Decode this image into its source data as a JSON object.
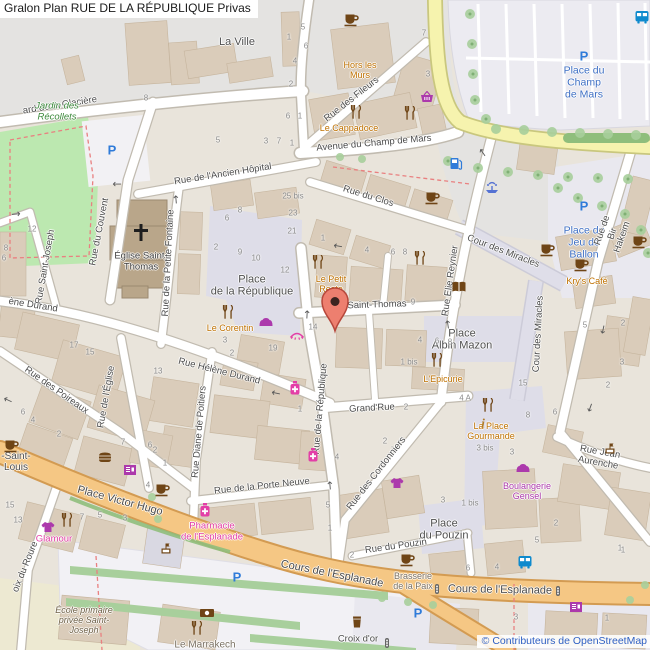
{
  "title": {
    "text": "Gralon Plan RUE DE LA RÉPUBLIQUE Privas"
  },
  "attribution": {
    "text": "© Contributeurs de OpenStreetMap"
  },
  "marker": {
    "color": "#ED7F6F"
  },
  "palette": {
    "road_primary": "#F5C784",
    "road_tertiary": "#F6F3AE",
    "road_minor": "#FFFFFF",
    "pedestrian": "#DEDDE8",
    "park": "#BCE8B0",
    "building": "#DACCBA",
    "poi_food": "#BF7100",
    "poi_shop": "#AC39AC",
    "poi_pink": "#E33FA7",
    "poi_transport_blue": "#2F7BD9",
    "place_blue": "#3E6FC4",
    "attribution_blue": "#2E5FC3"
  },
  "map": {
    "labels": [
      {
        "t": "ard de la Glacière",
        "x": 60,
        "y": 106,
        "r": -9,
        "k": "street"
      },
      {
        "t": "La Ville",
        "x": 237,
        "y": 42,
        "r": 0,
        "k": "place"
      },
      {
        "t": "Rue des Fileurs",
        "x": 352,
        "y": 100,
        "r": -38,
        "k": "street"
      },
      {
        "t": "Hors les\nMurs",
        "x": 360,
        "y": 70,
        "r": 0,
        "k": "food"
      },
      {
        "t": "Le Cappadoce",
        "x": 349,
        "y": 128,
        "r": 0,
        "k": "food"
      },
      {
        "t": "Avenue du Champ de Mars",
        "x": 374,
        "y": 144,
        "r": -5,
        "k": "street"
      },
      {
        "t": "Place du\nChamp\nde Mars",
        "x": 584,
        "y": 83,
        "r": 0,
        "k": "pblue"
      },
      {
        "t": "Rue de l'Ancien Hôpital",
        "x": 223,
        "y": 175,
        "r": -9,
        "k": "street"
      },
      {
        "t": "Rue du Clos",
        "x": 368,
        "y": 197,
        "r": 17,
        "k": "street"
      },
      {
        "t": "Rue du Couvent",
        "x": 100,
        "y": 232,
        "r": -79,
        "k": "street"
      },
      {
        "t": "Jardin des\nRécollets",
        "x": 57,
        "y": 112,
        "r": 0,
        "k": "park"
      },
      {
        "t": "Église Saint-\nThomas",
        "x": 141,
        "y": 262,
        "r": 0,
        "k": "church"
      },
      {
        "t": "Rue Saint-Joseph",
        "x": 46,
        "y": 267,
        "r": -80,
        "k": "street"
      },
      {
        "t": "Rue de la Petite Fontaine",
        "x": 169,
        "y": 263,
        "r": -87,
        "k": "street"
      },
      {
        "t": "Place\nde la République",
        "x": 252,
        "y": 286,
        "r": 0,
        "k": "place"
      },
      {
        "t": "Le Petit\nResto",
        "x": 331,
        "y": 284,
        "r": 0,
        "k": "food"
      },
      {
        "t": "Le Corentin",
        "x": 230,
        "y": 328,
        "r": 0,
        "k": "food"
      },
      {
        "t": "Rue Saint-Thomas",
        "x": 367,
        "y": 306,
        "r": -2,
        "k": "street"
      },
      {
        "t": "Rue Elie Reynier",
        "x": 451,
        "y": 281,
        "r": -82,
        "k": "street"
      },
      {
        "t": "Cour des Miracles",
        "x": 503,
        "y": 252,
        "r": 21,
        "k": "street"
      },
      {
        "t": "Cour des Miracles",
        "x": 539,
        "y": 334,
        "r": -87,
        "k": "street"
      },
      {
        "t": "Place du\nJeu de\nBallon",
        "x": 584,
        "y": 243,
        "r": 0,
        "k": "pblue"
      },
      {
        "t": "Kry's Café",
        "x": 587,
        "y": 281,
        "r": 0,
        "k": "food"
      },
      {
        "t": "Rue de Bir Hakeim",
        "x": 613,
        "y": 234,
        "r": -71,
        "k": "street"
      },
      {
        "t": "Place\nAlbin Mazon",
        "x": 462,
        "y": 340,
        "r": 0,
        "k": "place"
      },
      {
        "t": "L'Epicurie",
        "x": 443,
        "y": 379,
        "r": 0,
        "k": "food"
      },
      {
        "t": "ène Durand",
        "x": 33,
        "y": 306,
        "r": 9,
        "k": "street"
      },
      {
        "t": "Rue Hélène Durand",
        "x": 219,
        "y": 372,
        "r": 14,
        "k": "street"
      },
      {
        "t": "Rue des Poireaux",
        "x": 56,
        "y": 391,
        "r": 35,
        "k": "street"
      },
      {
        "t": "Rue de l'Église",
        "x": 107,
        "y": 397,
        "r": -80,
        "k": "street"
      },
      {
        "t": "Rue de la République",
        "x": 321,
        "y": 409,
        "r": -85,
        "k": "street"
      },
      {
        "t": "Grand'Rue",
        "x": 372,
        "y": 409,
        "r": -3,
        "k": "street"
      },
      {
        "t": "Rue Diane de Poitiers",
        "x": 200,
        "y": 432,
        "r": -85,
        "k": "street"
      },
      {
        "t": "La Place\nGourmande",
        "x": 491,
        "y": 431,
        "r": 0,
        "k": "food"
      },
      {
        "t": "Rue de la Porte Neuve",
        "x": 262,
        "y": 487,
        "r": -6,
        "k": "street"
      },
      {
        "t": "Rue des Cordonniers",
        "x": 377,
        "y": 474,
        "r": -52,
        "k": "street"
      },
      {
        "t": "Boulangerie\nGensel",
        "x": 527,
        "y": 491,
        "r": 0,
        "k": "shop"
      },
      {
        "t": "Rue Jean Aurenche",
        "x": 599,
        "y": 458,
        "r": 10,
        "k": "street"
      },
      {
        "t": "Place Victor Hugo",
        "x": 120,
        "y": 501,
        "r": 15,
        "k": "street",
        "fs": 11
      },
      {
        "t": "Pharmacie\nde l'Esplanade",
        "x": 212,
        "y": 532,
        "r": 0,
        "k": "pink"
      },
      {
        "t": "-Saint-\nLouis",
        "x": 16,
        "y": 462,
        "r": 0,
        "k": "place",
        "fs": 10
      },
      {
        "t": "Glamour",
        "x": 54,
        "y": 540,
        "r": 0,
        "k": "pink"
      },
      {
        "t": "Place\ndu Pouzin",
        "x": 444,
        "y": 530,
        "r": 0,
        "k": "place"
      },
      {
        "t": "Rue du Pouzin",
        "x": 396,
        "y": 547,
        "r": -8,
        "k": "street"
      },
      {
        "t": "Cours de l'Esplanade",
        "x": 332,
        "y": 574,
        "r": 11,
        "k": "street",
        "fs": 11
      },
      {
        "t": "Cours de l'Esplanade",
        "x": 500,
        "y": 590,
        "r": 1,
        "k": "street",
        "fs": 11
      },
      {
        "t": "Brasserie\nde la Paix",
        "x": 413,
        "y": 581,
        "r": 0,
        "k": "gpoi"
      },
      {
        "t": "oix du Roure",
        "x": 26,
        "y": 567,
        "r": -68,
        "k": "street"
      },
      {
        "t": "École primaire\nprivée Saint-\nJoseph",
        "x": 84,
        "y": 620,
        "r": 0,
        "k": "school"
      },
      {
        "t": "Le Marrakech",
        "x": 205,
        "y": 645,
        "r": 0,
        "k": "gpoi",
        "fs": 10
      },
      {
        "t": "Croix d'or",
        "x": 358,
        "y": 640,
        "r": 0,
        "k": "street"
      }
    ],
    "house_numbers": [
      [
        146,
        98,
        "8"
      ],
      [
        303,
        27,
        "5"
      ],
      [
        289,
        37,
        "1"
      ],
      [
        306,
        46,
        "6"
      ],
      [
        295,
        61,
        "4"
      ],
      [
        291,
        84,
        "2"
      ],
      [
        288,
        116,
        "6"
      ],
      [
        300,
        116,
        "1"
      ],
      [
        424,
        33,
        "7"
      ],
      [
        428,
        74,
        "3"
      ],
      [
        218,
        140,
        "5"
      ],
      [
        266,
        141,
        "3"
      ],
      [
        279,
        141,
        "7"
      ],
      [
        292,
        143,
        "1"
      ],
      [
        32,
        229,
        "12"
      ],
      [
        6,
        248,
        "8"
      ],
      [
        4,
        258,
        "6"
      ],
      [
        293,
        196,
        "25 bis"
      ],
      [
        293,
        213,
        "23"
      ],
      [
        292,
        231,
        "21"
      ],
      [
        240,
        210,
        "8"
      ],
      [
        227,
        218,
        "6"
      ],
      [
        216,
        247,
        "2"
      ],
      [
        240,
        252,
        "9"
      ],
      [
        256,
        258,
        "10"
      ],
      [
        285,
        270,
        "12"
      ],
      [
        323,
        238,
        "1"
      ],
      [
        367,
        250,
        "4"
      ],
      [
        393,
        252,
        "6"
      ],
      [
        405,
        252,
        "8"
      ],
      [
        74,
        345,
        "17"
      ],
      [
        90,
        352,
        "15"
      ],
      [
        158,
        371,
        "13"
      ],
      [
        225,
        340,
        "3"
      ],
      [
        232,
        353,
        "2"
      ],
      [
        273,
        348,
        "19"
      ],
      [
        346,
        296,
        "1"
      ],
      [
        413,
        302,
        "9"
      ],
      [
        313,
        327,
        "14"
      ],
      [
        300,
        409,
        "1"
      ],
      [
        406,
        407,
        "2"
      ],
      [
        385,
        441,
        "2"
      ],
      [
        337,
        457,
        "4"
      ],
      [
        409,
        362,
        "1 bis"
      ],
      [
        23,
        412,
        "6"
      ],
      [
        33,
        420,
        "4"
      ],
      [
        59,
        434,
        "2"
      ],
      [
        165,
        463,
        "1"
      ],
      [
        123,
        442,
        "7"
      ],
      [
        150,
        445,
        "6"
      ],
      [
        155,
        450,
        "2"
      ],
      [
        148,
        485,
        "4"
      ],
      [
        10,
        505,
        "15"
      ],
      [
        18,
        520,
        "13"
      ],
      [
        82,
        517,
        "7"
      ],
      [
        100,
        515,
        "5"
      ],
      [
        125,
        518,
        "3"
      ],
      [
        328,
        505,
        "5"
      ],
      [
        330,
        528,
        "1"
      ],
      [
        352,
        555,
        "2"
      ],
      [
        443,
        500,
        "3"
      ],
      [
        470,
        503,
        "1 bis"
      ],
      [
        468,
        568,
        "6"
      ],
      [
        497,
        567,
        "4"
      ],
      [
        620,
        548,
        "1"
      ],
      [
        516,
        617,
        "3"
      ],
      [
        607,
        618,
        "1"
      ],
      [
        485,
        448,
        "3 bis"
      ],
      [
        512,
        452,
        "3"
      ],
      [
        528,
        415,
        "8"
      ],
      [
        555,
        412,
        "6"
      ],
      [
        523,
        383,
        "15"
      ],
      [
        465,
        398,
        "4 A"
      ],
      [
        556,
        523,
        "2"
      ],
      [
        537,
        540,
        "5"
      ],
      [
        623,
        550,
        "1"
      ],
      [
        585,
        325,
        "5"
      ],
      [
        623,
        323,
        "2"
      ],
      [
        622,
        362,
        "3"
      ],
      [
        608,
        385,
        "2"
      ],
      [
        420,
        340,
        "4"
      ],
      [
        437,
        341,
        "6"
      ],
      [
        450,
        342,
        "8"
      ]
    ],
    "icons": [
      [
        "cafe",
        352,
        20
      ],
      [
        "cafe",
        433,
        198
      ],
      [
        "cafe",
        548,
        250
      ],
      [
        "cafe",
        582,
        265
      ],
      [
        "cafe",
        640,
        242
      ],
      [
        "cafe",
        12,
        446
      ],
      [
        "cafe",
        163,
        490
      ],
      [
        "cafe",
        408,
        560
      ],
      [
        "restaurant",
        356,
        112
      ],
      [
        "restaurant",
        410,
        113
      ],
      [
        "restaurant",
        318,
        262
      ],
      [
        "restaurant",
        228,
        312
      ],
      [
        "restaurant",
        420,
        258
      ],
      [
        "restaurant",
        437,
        360
      ],
      [
        "restaurant",
        488,
        405
      ],
      [
        "restaurant",
        67,
        520
      ],
      [
        "restaurant",
        197,
        628
      ],
      [
        "parking",
        112,
        150
      ],
      [
        "parking",
        584,
        56
      ],
      [
        "parking",
        584,
        206
      ],
      [
        "parking",
        237,
        577
      ],
      [
        "parking",
        418,
        613
      ],
      [
        "fuel",
        456,
        163
      ],
      [
        "fountain",
        492,
        188
      ],
      [
        "bus",
        525,
        562
      ],
      [
        "bus",
        642,
        17
      ],
      [
        "bakery",
        266,
        322
      ],
      [
        "bakery",
        523,
        468
      ],
      [
        "pharmacy",
        295,
        388
      ],
      [
        "pharmacy",
        313,
        455
      ],
      [
        "pharmacy",
        205,
        510
      ],
      [
        "clothes",
        397,
        483
      ],
      [
        "clothes",
        48,
        527
      ],
      [
        "basket",
        427,
        97
      ],
      [
        "book",
        459,
        287
      ],
      [
        "money",
        207,
        613
      ],
      [
        "kiosk",
        130,
        470
      ],
      [
        "kiosk",
        576,
        607
      ],
      [
        "burger",
        105,
        457
      ],
      [
        "bar",
        357,
        622
      ],
      [
        "beauty",
        297,
        336
      ],
      [
        "info",
        483,
        423
      ],
      [
        "monument",
        610,
        448
      ],
      [
        "monument",
        166,
        548
      ],
      [
        "traffic",
        437,
        589
      ],
      [
        "traffic",
        558,
        591
      ],
      [
        "traffic",
        387,
        643
      ]
    ],
    "arrows": [
      [
        "←",
        338,
        246,
        10
      ],
      [
        "←",
        276,
        393,
        12
      ],
      [
        "↑",
        307,
        315,
        3
      ],
      [
        "↑",
        330,
        486,
        -5
      ],
      [
        "→",
        16,
        214,
        -5
      ],
      [
        "↑",
        176,
        200,
        -5
      ],
      [
        "←",
        8,
        400,
        25
      ],
      [
        "←",
        117,
        184,
        0
      ],
      [
        "↑",
        448,
        325,
        -8
      ],
      [
        "↑",
        483,
        153,
        -35
      ],
      [
        "↓",
        603,
        330,
        12
      ],
      [
        "↓",
        590,
        408,
        20
      ]
    ]
  }
}
